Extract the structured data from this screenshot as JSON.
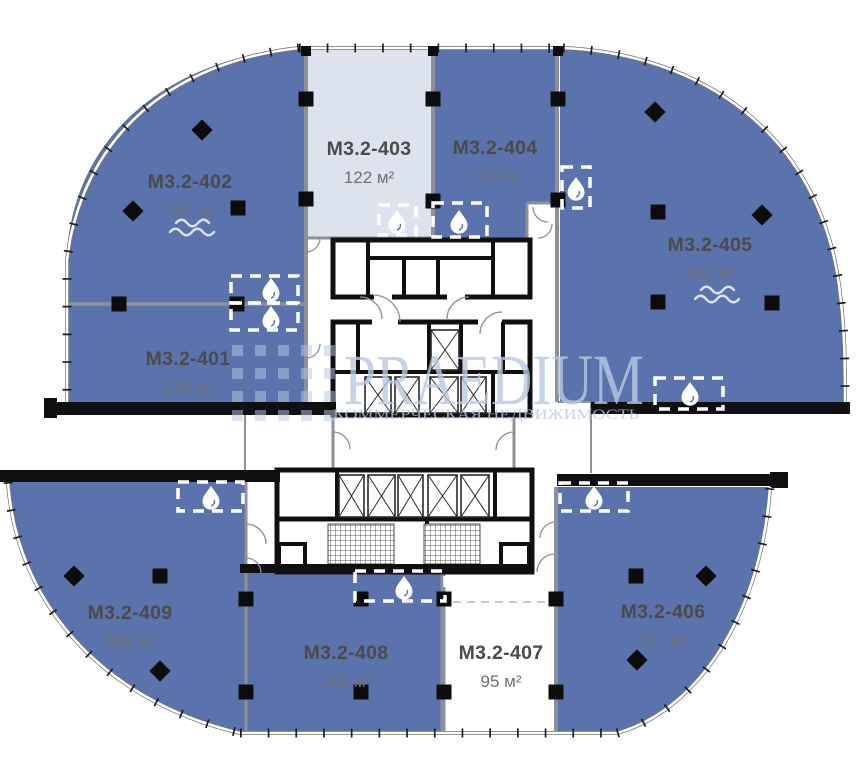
{
  "floorplan": {
    "units": [
      {
        "id": "M3.2-401",
        "area": "134 м²",
        "fill": "blue",
        "icons": [
          "water-drop"
        ]
      },
      {
        "id": "M3.2-402",
        "area": "245 м²",
        "fill": "blue",
        "icons": [
          "water-drop",
          "waves"
        ]
      },
      {
        "id": "M3.2-403",
        "area": "122 м²",
        "fill": "light",
        "icons": [
          "water-drop"
        ]
      },
      {
        "id": "M3.2-404",
        "area": "116 м²",
        "fill": "blue",
        "icons": [
          "water-drop"
        ]
      },
      {
        "id": "M3.2-405",
        "area": "441 м²",
        "fill": "blue",
        "icons": [
          "water-drop",
          "water-drop",
          "waves"
        ]
      },
      {
        "id": "M3.2-406",
        "area": "221 м²",
        "fill": "blue",
        "icons": [
          "water-drop"
        ]
      },
      {
        "id": "M3.2-407",
        "area": "95 м²",
        "fill": "white",
        "icons": []
      },
      {
        "id": "M3.2-408",
        "area": "169 м²",
        "fill": "blue",
        "icons": [
          "water-drop"
        ]
      },
      {
        "id": "M3.2-409",
        "area": "259 м²",
        "fill": "blue",
        "icons": [
          "water-drop"
        ]
      }
    ],
    "watermark": {
      "brand": "PRAEDIUM",
      "subtitle": "КОММЕРЧЕСКАЯ НЕДВИЖИМОСТЬ"
    },
    "colors": {
      "unit_blue": "#5b73ac",
      "unit_light": "#dce3ef",
      "unit_white": "#ffffff",
      "wall_black": "#101010",
      "wall_gray": "#8d9096",
      "watermark_blue": "#b9c8e2",
      "label_dark": "#4b4b4b",
      "label_area": "#717171",
      "icon_white": "#ffffff"
    }
  }
}
